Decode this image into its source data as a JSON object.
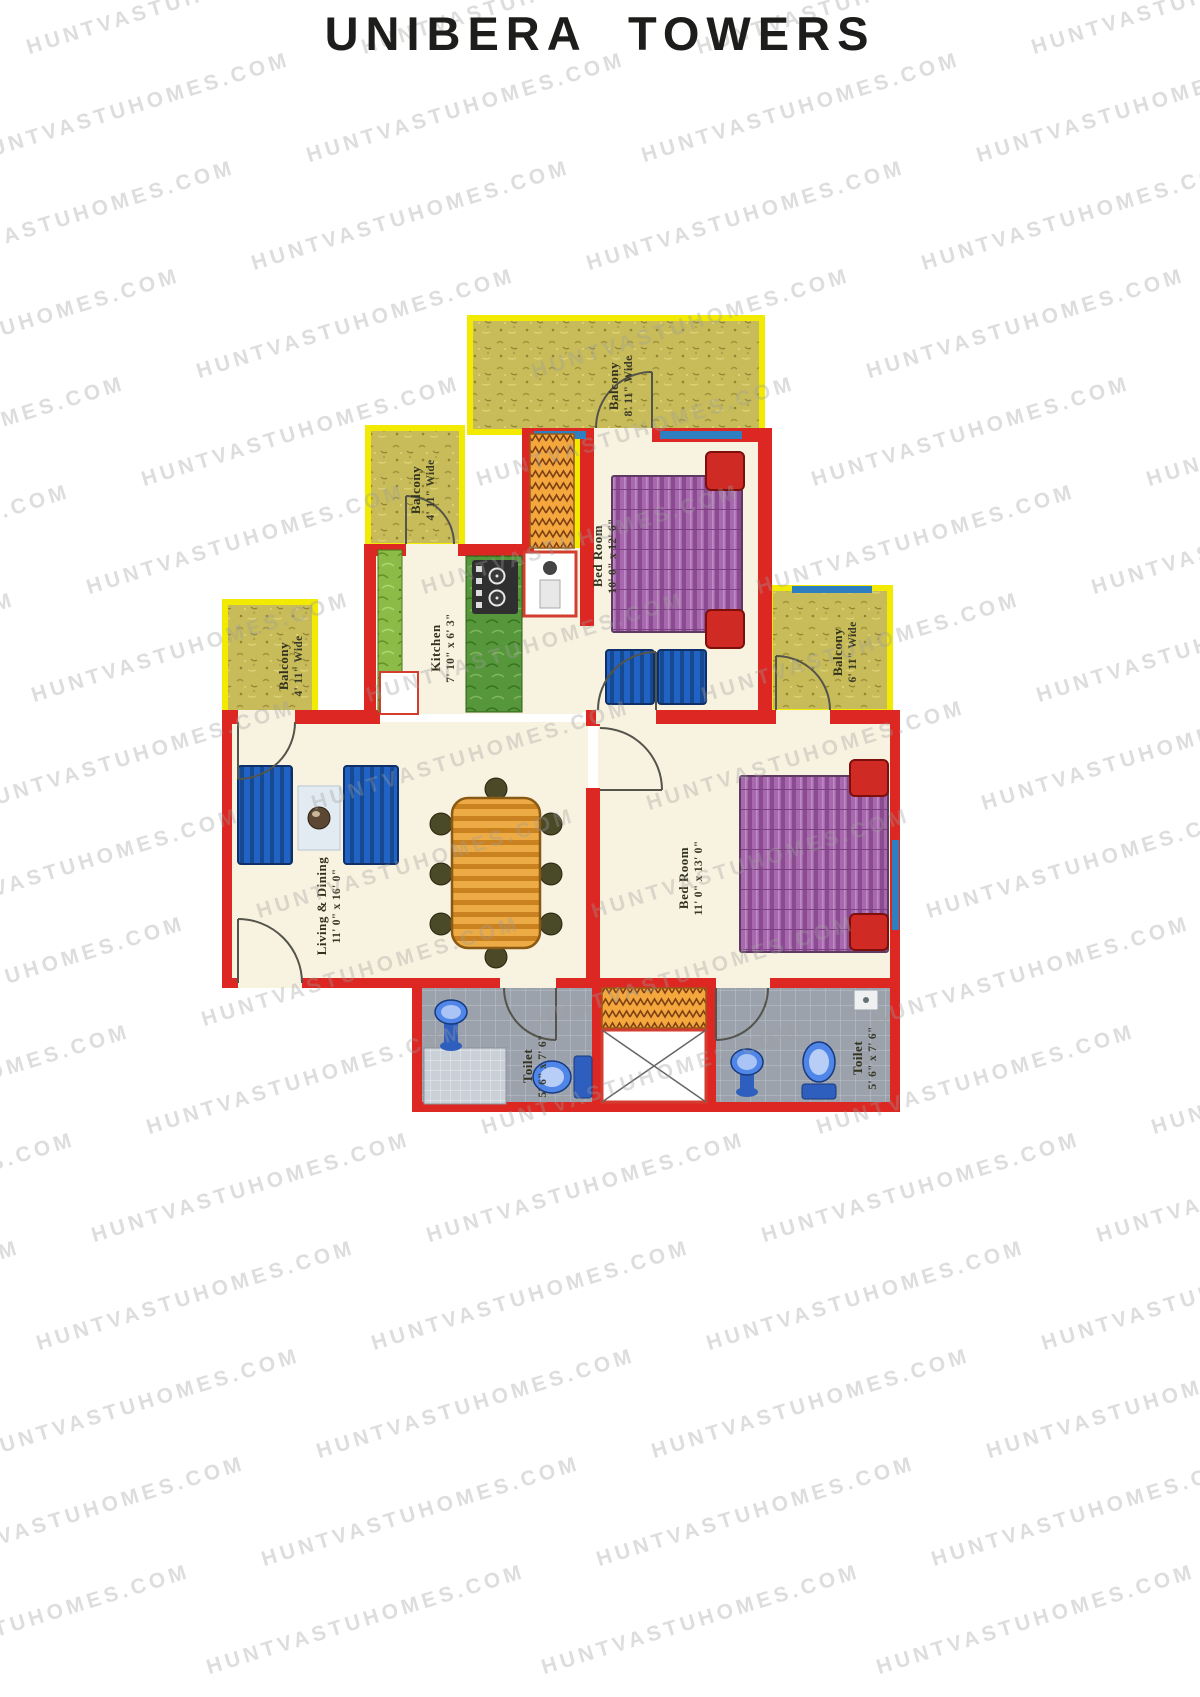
{
  "page": {
    "title": "UNIBERA TOWERS"
  },
  "watermark": {
    "text": "HUNTVASTUHOMES.COM"
  },
  "plan": {
    "rooms": {
      "balcony_top": {
        "name": "Balcony",
        "size": "8' 11\" Wide"
      },
      "balcony_upper_left": {
        "name": "Balcony",
        "size": "4' 11\" Wide"
      },
      "balcony_mid_left": {
        "name": "Balcony",
        "size": "4' 11\" Wide"
      },
      "balcony_right": {
        "name": "Balcony",
        "size": "6' 11\" Wide"
      },
      "bedroom_top": {
        "name": "Bed Room",
        "size": "10' 0\" x 12' 6\""
      },
      "bedroom_right": {
        "name": "Bed Room",
        "size": "11' 0\" x 13' 0\""
      },
      "kitchen": {
        "name": "Kitchen",
        "size": "7' 10\" x 6' 3\""
      },
      "living_dining": {
        "name": "Living & Dining",
        "size": "11' 0\" x 16' 0\""
      },
      "toilet_left": {
        "name": "Toilet",
        "size": "5' 6\" x 7' 6\""
      },
      "toilet_right": {
        "name": "Toilet",
        "size": "5' 6\" x 7' 6\""
      }
    },
    "colors": {
      "wall": "#dc2722",
      "balcony_fill": "#c8bb59",
      "balcony_frame": "#f2ea00",
      "floor": "#f8f3e1",
      "tile": "#9ba2ac",
      "bed": "#a868ad",
      "sofa": "#2063c4",
      "dining": "#ecab44",
      "window": "#2d7fc0",
      "pillow": "#cf2b24"
    }
  }
}
